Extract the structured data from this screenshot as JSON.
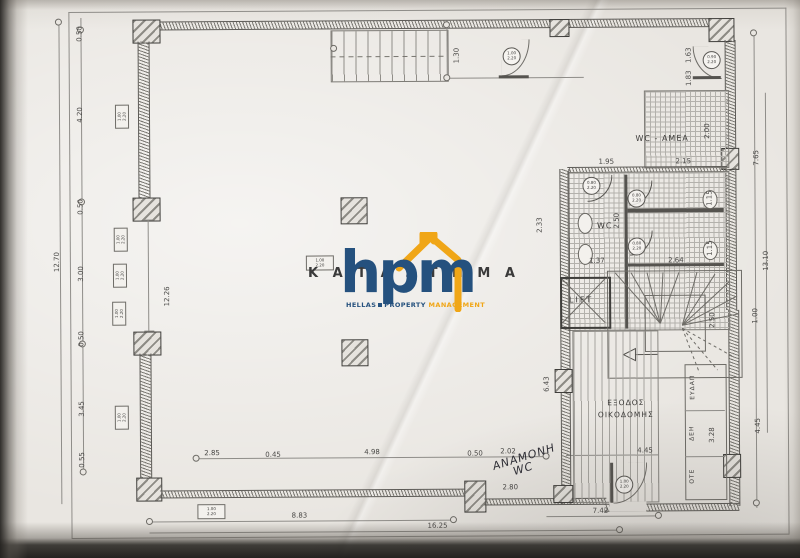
{
  "document": {
    "type": "scanned architectural floor plan",
    "colors": {
      "paper": "#e9e6e1",
      "ink": "#4a4947",
      "navy": "#25517e",
      "yellow": "#f0a617"
    }
  },
  "watermark": {
    "behind_text": "Κ Α Τ Α Σ Τ Η Μ Α",
    "logo_text": "hpm",
    "tagline_1": "HELLAS",
    "tagline_2": "PROPERTY",
    "tagline_3": "MANAGEMENT"
  },
  "rooms": {
    "wc_amea": "WC - AMEA",
    "wc": "WC",
    "lift": "LIFT",
    "exit_line1": "ΕΞΟΔΟΣ",
    "exit_line2": "ΟΙΚΟΔΟΜΗΣ",
    "eydap": "ΕΥΔΑΠ",
    "deh": "ΔΕΗ",
    "ote": "ΟΤΕ"
  },
  "handwritten_note": {
    "line1": "ΑΝΑΜΟΝΗ",
    "line2": "WC"
  },
  "dims": {
    "left_a": "0.50",
    "left_b": "4.20",
    "left_c": "0.50",
    "left_d": "3.00",
    "left_e": "0.50",
    "left_f": "3.45",
    "left_g": "0.55",
    "left_total": "12.70",
    "left_inner": "12.26",
    "top_stair": "1.30",
    "right_a": "1.63",
    "right_total_a": "7.65",
    "right_total_b": "13.10",
    "right_b": "1.00",
    "right_c": "4.45",
    "wc_amea_w": "2.15",
    "wc_amea_h": "2.00",
    "wc_amea_left": "1.95",
    "wc_amea_door": "1.83",
    "wc_h": "2.50",
    "wc_out": "2.33",
    "wc_w1": "1.37",
    "wc_w2": "2.64",
    "wc_t1": "1.15",
    "wc_t2": "1.15",
    "stair_h": "2.50",
    "hall_h": "6.43",
    "util_h": "3.28",
    "bot_a": "2.85",
    "bot_b": "0.45",
    "bot_c": "4.98",
    "bot_d": "0.50",
    "bot_e": "2.02",
    "bot_f": "2.80",
    "bot_g": "4.45",
    "bot_total_a": "8.83",
    "bot_total_b": "16.25",
    "bot_total_c": "7.42"
  },
  "tags": {
    "c1": {
      "a": "1.00",
      "b": "2.20"
    },
    "c2": {
      "a": "0.90",
      "b": "2.20"
    },
    "c3": {
      "a": "0.80",
      "b": "2.20"
    },
    "c4": {
      "a": "0.80",
      "b": "2.20"
    },
    "c5": {
      "a": "0.80",
      "b": "2.20"
    },
    "c6": {
      "a": "1.00",
      "b": "2.20"
    },
    "wtag": {
      "a": "1.00",
      "b": "2.20"
    }
  }
}
